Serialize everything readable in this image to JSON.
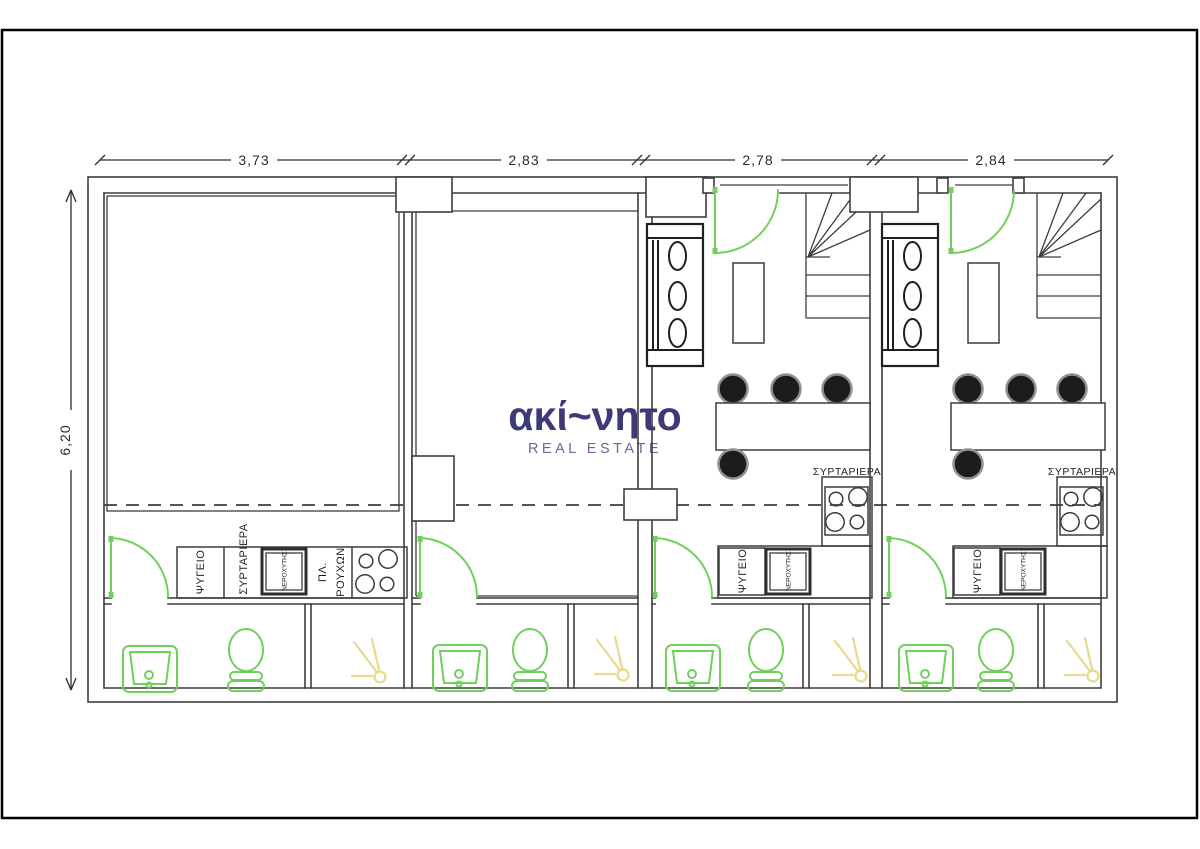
{
  "watermark": {
    "brand": "ακί~νητο",
    "subtitle": "REAL ESTATE"
  },
  "dimensions": {
    "top": [
      "3,73",
      "2,83",
      "2,78",
      "2,84"
    ],
    "left": "6,20"
  },
  "labels": {
    "fridge": "ΨΥΓΕΙΟ",
    "drawers": "ΣΥΡΤΑΡΙΕΡΑ",
    "sink": "ΝΕΡΟΧΥΤΗΣ",
    "washing_line1": "ΠΛ.",
    "washing_line2": "ΡΟΥΧΩΝ"
  },
  "colors": {
    "wall": "#3d3d3d",
    "fixture_green": "#71d05c",
    "shower_yellow": "#e9d98b",
    "chair_fill": "#1c1c1c",
    "chair_ring": "#919191",
    "brand": "#3e3a78",
    "brand_sub": "#6b66a0",
    "frame": "#000000"
  }
}
